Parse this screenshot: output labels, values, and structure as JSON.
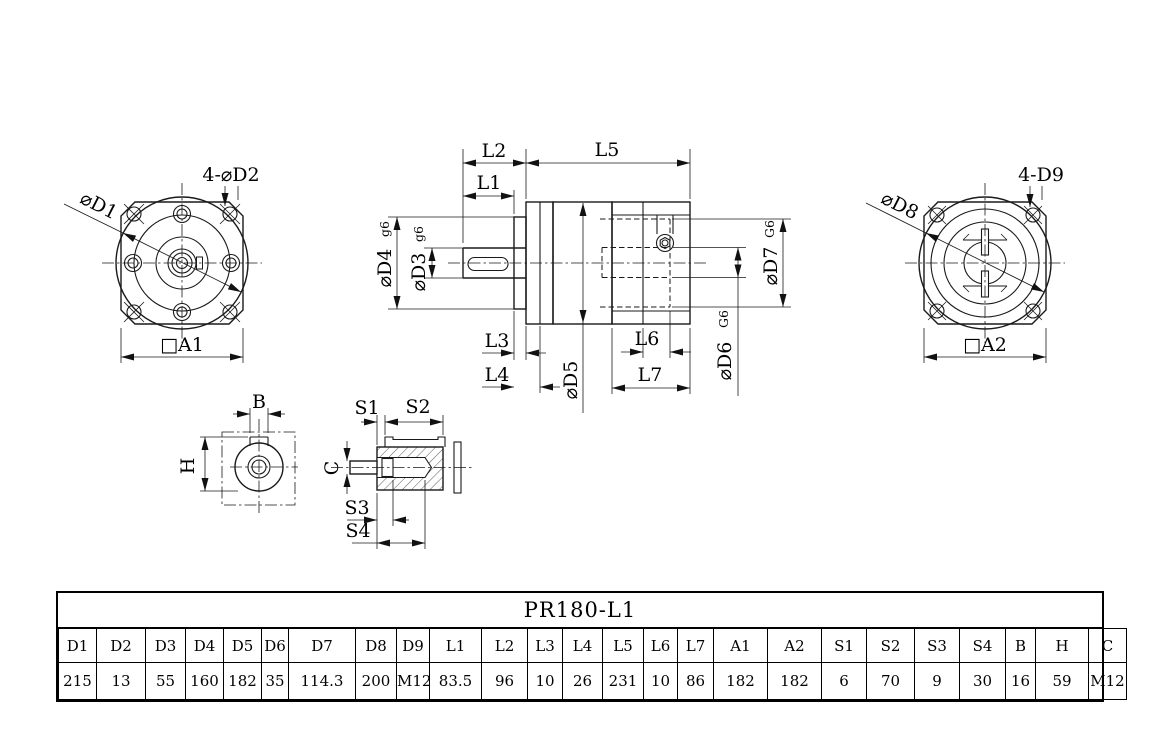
{
  "drawing": {
    "front_view": {
      "dia_label": "⌀D1",
      "holes_label": "4-⌀D2",
      "square_label": "□A1"
    },
    "side_view": {
      "l1": "L1",
      "l2": "L2",
      "l3": "L3",
      "l4": "L4",
      "l5": "L5",
      "l6": "L6",
      "l7": "L7",
      "d3": "⌀D3",
      "d3_fit": "g6",
      "d4": "⌀D4",
      "d4_fit": "g6",
      "d5": "⌀D5",
      "d6": "⌀D6",
      "d6_fit": "G6",
      "d7": "⌀D7",
      "d7_fit": "G6"
    },
    "rear_view": {
      "dia_label": "⌀D8",
      "holes_label": "4-D9",
      "square_label": "□A2"
    },
    "key_section": {
      "b": "B",
      "h": "H"
    },
    "shaft_section": {
      "s1": "S1",
      "s2": "S2",
      "s3": "S3",
      "s4": "S4",
      "c": "C"
    }
  },
  "table": {
    "title": "PR180-L1",
    "columns": [
      {
        "header": "D1",
        "value": "215"
      },
      {
        "header": "D2",
        "value": "13"
      },
      {
        "header": "D3",
        "value": "55"
      },
      {
        "header": "D4",
        "value": "160"
      },
      {
        "header": "D5",
        "value": "182"
      },
      {
        "header": "D6",
        "value": "35"
      },
      {
        "header": "D7",
        "value": "114.3"
      },
      {
        "header": "D8",
        "value": "200"
      },
      {
        "header": "D9",
        "value": "M12"
      },
      {
        "header": "L1",
        "value": "83.5"
      },
      {
        "header": "L2",
        "value": "96"
      },
      {
        "header": "L3",
        "value": "10"
      },
      {
        "header": "L4",
        "value": "26"
      },
      {
        "header": "L5",
        "value": "231"
      },
      {
        "header": "L6",
        "value": "10"
      },
      {
        "header": "L7",
        "value": "86"
      },
      {
        "header": "A1",
        "value": "182"
      },
      {
        "header": "A2",
        "value": "182"
      },
      {
        "header": "S1",
        "value": "6"
      },
      {
        "header": "S2",
        "value": "70"
      },
      {
        "header": "S3",
        "value": "9"
      },
      {
        "header": "S4",
        "value": "30"
      },
      {
        "header": "B",
        "value": "16"
      },
      {
        "header": "H",
        "value": "59"
      },
      {
        "header": "C",
        "value": "M12"
      }
    ]
  }
}
